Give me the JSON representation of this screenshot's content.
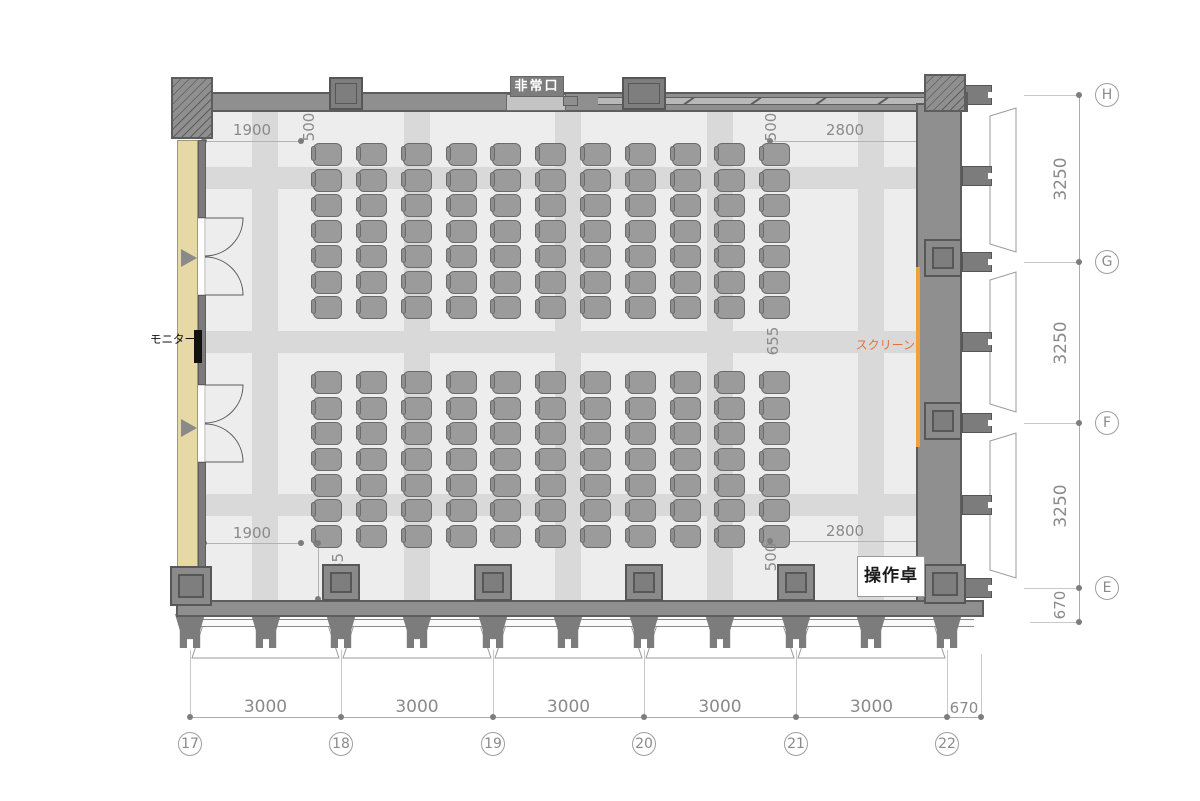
{
  "labels": {
    "exit_sign": "非常口",
    "monitor": "モニター",
    "screen": "スクリーン",
    "console": "操作卓"
  },
  "colors": {
    "wall": "#8f8f8f",
    "wall_edge": "#5d5d5d",
    "pilaster": "#7e7e7e",
    "floor": "#ededed",
    "band": "#d9d9d9",
    "seat": "#9b9b9b",
    "seat_border": "#6b6b6b",
    "seat_back": "#8e8e8e",
    "wood_finish": "#e6d9a5",
    "screen_line": "#f2a13a",
    "screen_text": "#e8722d",
    "dim_text": "#8a8a8a",
    "dim_line": "#b3b3b3",
    "dim_dot": "#7d7d7d",
    "window_line": "#9a9a9a"
  },
  "grid": {
    "columns": [
      {
        "label": "17",
        "x": 190
      },
      {
        "label": "18",
        "x": 341
      },
      {
        "label": "19",
        "x": 493
      },
      {
        "label": "20",
        "x": 644
      },
      {
        "label": "21",
        "x": 796
      },
      {
        "label": "22",
        "x": 947
      }
    ],
    "col_dims": [
      "3000",
      "3000",
      "3000",
      "3000",
      "3000"
    ],
    "col_tail_dim": "670",
    "tail_x": 981,
    "rows": [
      {
        "label": "H",
        "y": 95
      },
      {
        "label": "G",
        "y": 262
      },
      {
        "label": "F",
        "y": 423
      },
      {
        "label": "E",
        "y": 588
      }
    ],
    "row_dims": [
      "3250",
      "3250",
      "3250"
    ],
    "row_tail_dim": "670",
    "tail_y": 622
  },
  "dimensions": [
    {
      "text": "1900",
      "type": "hline",
      "x1": 204,
      "x2": 301,
      "y": 141,
      "lx": 252,
      "ly": 130
    },
    {
      "text": "500",
      "type": "rot",
      "x": 309,
      "y": 127
    },
    {
      "text": "2800",
      "type": "hline",
      "x1": 770,
      "x2": 920,
      "y": 141,
      "lx": 845,
      "ly": 130
    },
    {
      "text": "500",
      "type": "rot",
      "x": 771,
      "y": 127
    },
    {
      "text": "655",
      "type": "rot",
      "x": 773,
      "y": 341
    },
    {
      "text": "1900",
      "type": "hline",
      "x1": 204,
      "x2": 301,
      "y": 543,
      "lx": 252,
      "ly": 533
    },
    {
      "text": "1185",
      "type": "vline",
      "x": 318,
      "y1": 543,
      "y2": 599,
      "lx": 338,
      "ly": 572
    },
    {
      "text": "500",
      "type": "rot",
      "x": 771,
      "y": 557
    },
    {
      "text": "2800",
      "type": "hline",
      "x1": 770,
      "x2": 920,
      "y": 541,
      "lx": 845,
      "ly": 531
    }
  ],
  "seating": {
    "columns": 11,
    "rows_per_block": 7,
    "blocks": 2,
    "seat_count": 154,
    "seat_w": 29,
    "seat_h": 23,
    "cols_x": [
      313,
      358,
      403,
      448,
      492,
      537,
      582,
      627,
      672,
      716,
      761
    ],
    "block1_rows_y": [
      143,
      169,
      194,
      220,
      245,
      271,
      296
    ],
    "block2_rows_y": [
      371,
      397,
      422,
      448,
      474,
      499,
      525
    ]
  },
  "floor": {
    "bands_x": [
      265,
      417,
      568,
      720,
      871
    ],
    "bands_y": [
      178,
      342,
      505
    ]
  },
  "structure": {
    "feet_x": [
      190,
      266,
      341,
      417,
      493,
      568,
      644,
      720,
      796,
      871,
      947
    ],
    "right_fins_y": [
      95,
      176,
      262,
      342,
      423,
      505,
      588
    ],
    "right_window_bays": [
      [
        108,
        252
      ],
      [
        272,
        412
      ],
      [
        433,
        578
      ]
    ],
    "bottom_columns_x": [
      341,
      493,
      644,
      796
    ],
    "right_columns_y": [
      239,
      402
    ],
    "top_pilasters": [
      {
        "x": 329,
        "w": 34
      },
      {
        "x": 622,
        "w": 44
      }
    ],
    "wall_ticks_x": [
      688,
      755,
      820,
      882
    ]
  }
}
